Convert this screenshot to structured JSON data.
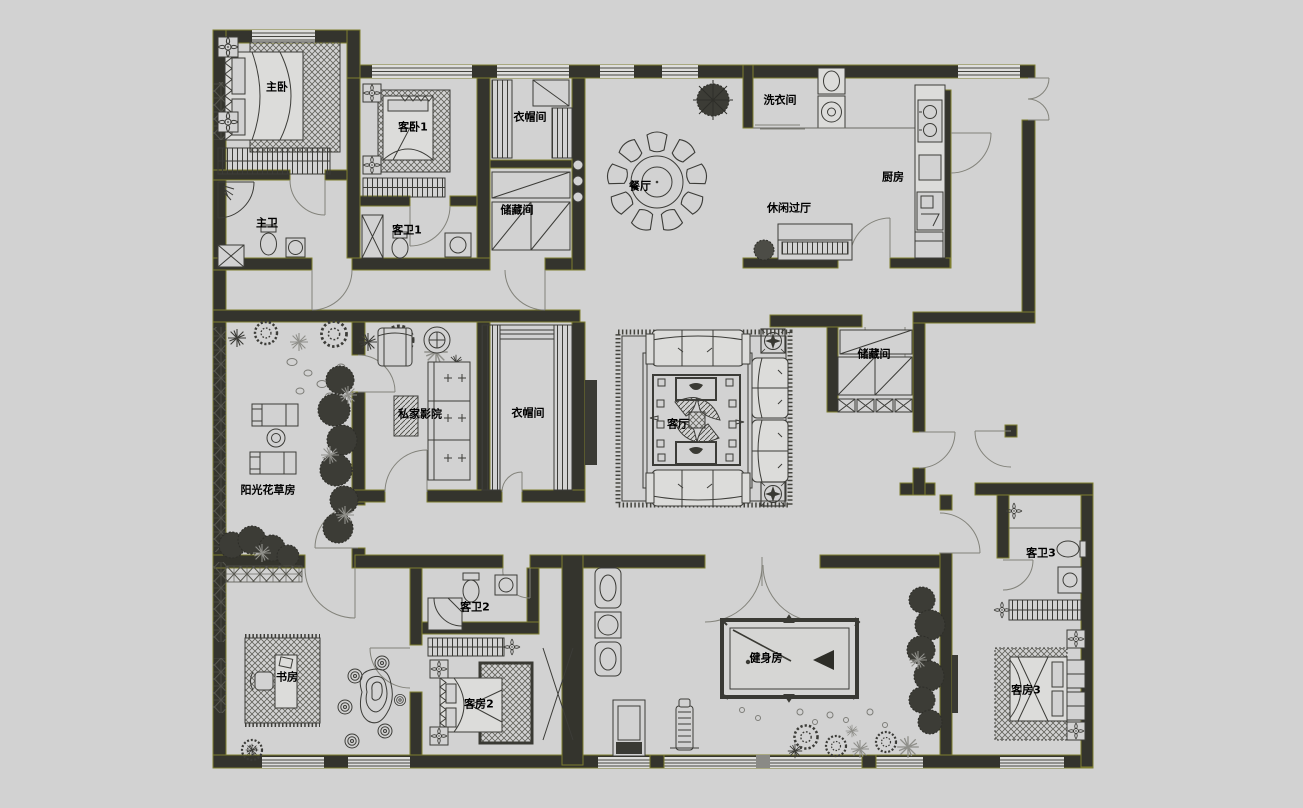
{
  "canvas": {
    "background_color": "#d2d2d2",
    "wall_color": "#34342d",
    "wall_edge_color": "#7e7e2f",
    "furniture_line_color": "#3c3c38",
    "door_arc_color": "#83837b"
  },
  "floor_plan": {
    "type": "residential-floor-plan",
    "rooms": [
      {
        "id": "master-bedroom",
        "label": "主卧",
        "x": 277,
        "y": 87
      },
      {
        "id": "guest-bedroom-1",
        "label": "客卧1",
        "x": 413,
        "y": 127
      },
      {
        "id": "cloakroom-north",
        "label": "衣帽间",
        "x": 530,
        "y": 117
      },
      {
        "id": "storage-north",
        "label": "储藏间",
        "x": 517,
        "y": 210
      },
      {
        "id": "dining-room",
        "label": "餐厅",
        "x": 640,
        "y": 186
      },
      {
        "id": "laundry-room",
        "label": "洗衣间",
        "x": 780,
        "y": 100
      },
      {
        "id": "leisure-hall",
        "label": "休闲过厅",
        "x": 789,
        "y": 208
      },
      {
        "id": "kitchen",
        "label": "厨房",
        "x": 893,
        "y": 177
      },
      {
        "id": "master-bathroom",
        "label": "主卫",
        "x": 267,
        "y": 223
      },
      {
        "id": "guest-bathroom-1",
        "label": "客卫1",
        "x": 407,
        "y": 230
      },
      {
        "id": "private-cinema",
        "label": "私家影院",
        "x": 420,
        "y": 414
      },
      {
        "id": "cloakroom-middle",
        "label": "衣帽间",
        "x": 528,
        "y": 413
      },
      {
        "id": "sunroom",
        "label": "阳光花草房",
        "x": 268,
        "y": 490
      },
      {
        "id": "living-room",
        "label": "客厅",
        "x": 678,
        "y": 424
      },
      {
        "id": "storage-middle",
        "label": "储藏间",
        "x": 874,
        "y": 354
      },
      {
        "id": "guest-bathroom-3",
        "label": "客卫3",
        "x": 1041,
        "y": 553
      },
      {
        "id": "study",
        "label": "书房",
        "x": 287,
        "y": 677
      },
      {
        "id": "guest-bathroom-2",
        "label": "客卫2",
        "x": 475,
        "y": 607
      },
      {
        "id": "guest-bedroom-2",
        "label": "客房2",
        "x": 479,
        "y": 704
      },
      {
        "id": "gym",
        "label": "健身房",
        "x": 766,
        "y": 658
      },
      {
        "id": "guest-bedroom-3",
        "label": "客房3",
        "x": 1026,
        "y": 690
      }
    ]
  }
}
